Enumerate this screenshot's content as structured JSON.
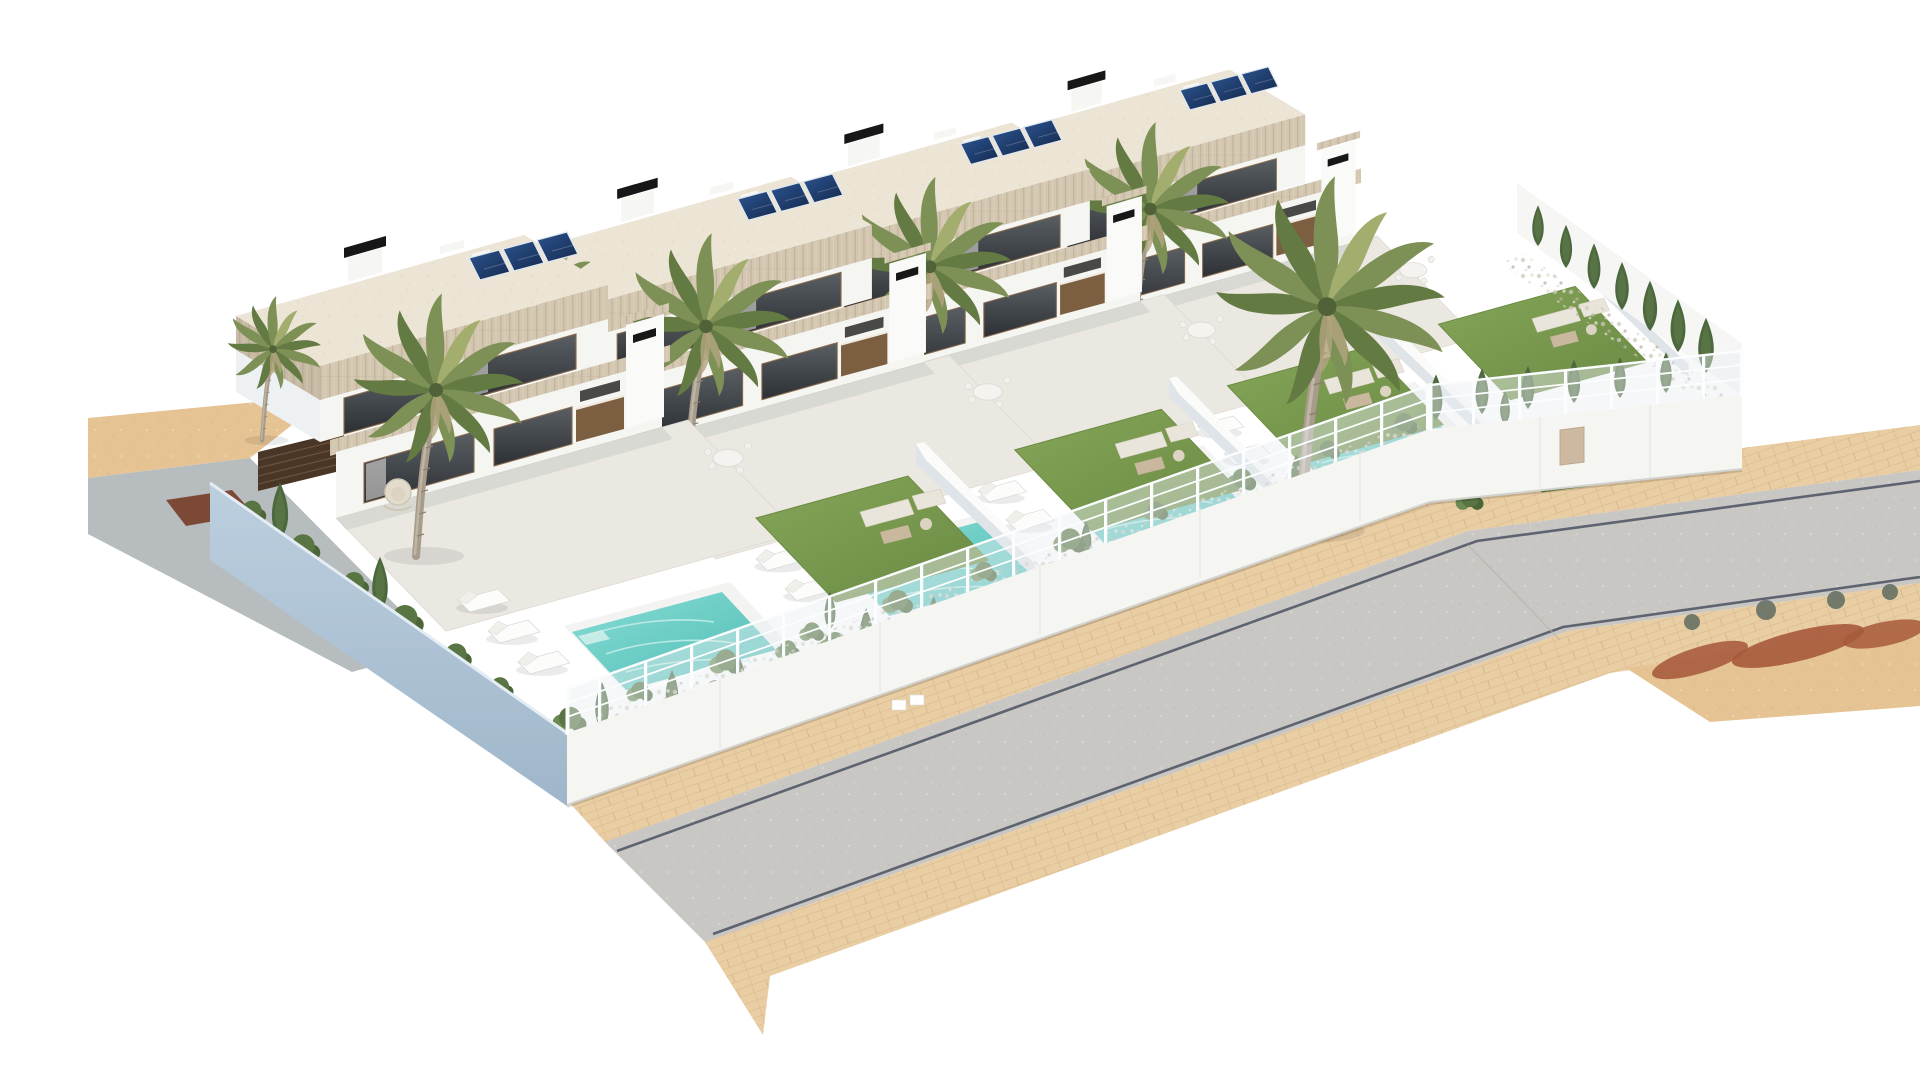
{
  "scene": {
    "title": "Aerial render of four new-build villas with pools",
    "description": "Photorealistic aerial 3D architectural rendering of a terraced row of four modern two-storey white villas with flat roofs, rooftop solar panels, black chimney caps and travertine fascia bands. Each villa has a private landscaped garden with a turquoise swimming pool, sun loungers, outdoor sofas, palm trees, cypresses and lawn, enclosed by white walls topped with a white wire fence. A light-blue shaded perimeter wall runs along the left, and a grey asphalt street with brick-paved sidewalks curves along the front, with sandy ground and reddish tree shadows at the edges, all on a pure white background.",
    "view": "aerial isometric-perspective",
    "background": "white",
    "villa_count": 4,
    "pool_count": 4,
    "solar_array_count": 4,
    "palm_tree_count": 5,
    "street": {
      "surface": "asphalt",
      "sidewalks": "brick-paved",
      "segments": 2,
      "markings": "dark curb lines"
    },
    "vegetation": [
      "palm trees",
      "cypresses",
      "hedge shrubs",
      "lawn patches",
      "gravel beds"
    ]
  },
  "palette": {
    "bg": "#ffffff",
    "roof": "#ece4d4",
    "wall_white": "#f5f5f2",
    "house_side_blue": "#c7d6e2",
    "wall_blue_top": "#bccfdf",
    "wall_blue_bottom": "#9fb6ca",
    "glass_top": "#5a5f64",
    "glass_bottom": "#2c3034",
    "wood": "#8a6a4c",
    "kitchen_wood": "#7c5e40",
    "solar_top": "#2c5490",
    "solar_bottom": "#152a4e",
    "black": "#171717",
    "lawn_top": "#85a558",
    "lawn_bottom": "#6a8a44",
    "lawn_edge": "#6a8a43",
    "shrub_dark": "#4c683e",
    "palm_main": "#7d9055",
    "palm_dark": "#637a42",
    "palm_light": "#a3ad6e",
    "trunk": "#a79b8b",
    "water_top": "#86dcd4",
    "water_bottom": "#4fbdb5",
    "coping": "#f3f4f1",
    "terrace": "#eae8e1",
    "divider_side": "#dfe4e9",
    "fence_white": "#fbfdfe",
    "sidewalk": "#e9cda3",
    "sidewalk_line": "#d8b78c",
    "road": "#c9c7c4",
    "curb": "#4a5262",
    "sand": "#e6c392",
    "driveway": "#b7bcbf",
    "patch_red": "#7d4937",
    "red_shadow": "#a65a3b",
    "slat_wood": "#4a3626",
    "trav_base": "#d3c7b2",
    "trav_dark": "#c3b59c",
    "trav_light": "#decfb9",
    "gravel_a": "#cfc9bc",
    "gravel_b": "#b9b2a4",
    "gravel_c": "#e4dfd4"
  }
}
